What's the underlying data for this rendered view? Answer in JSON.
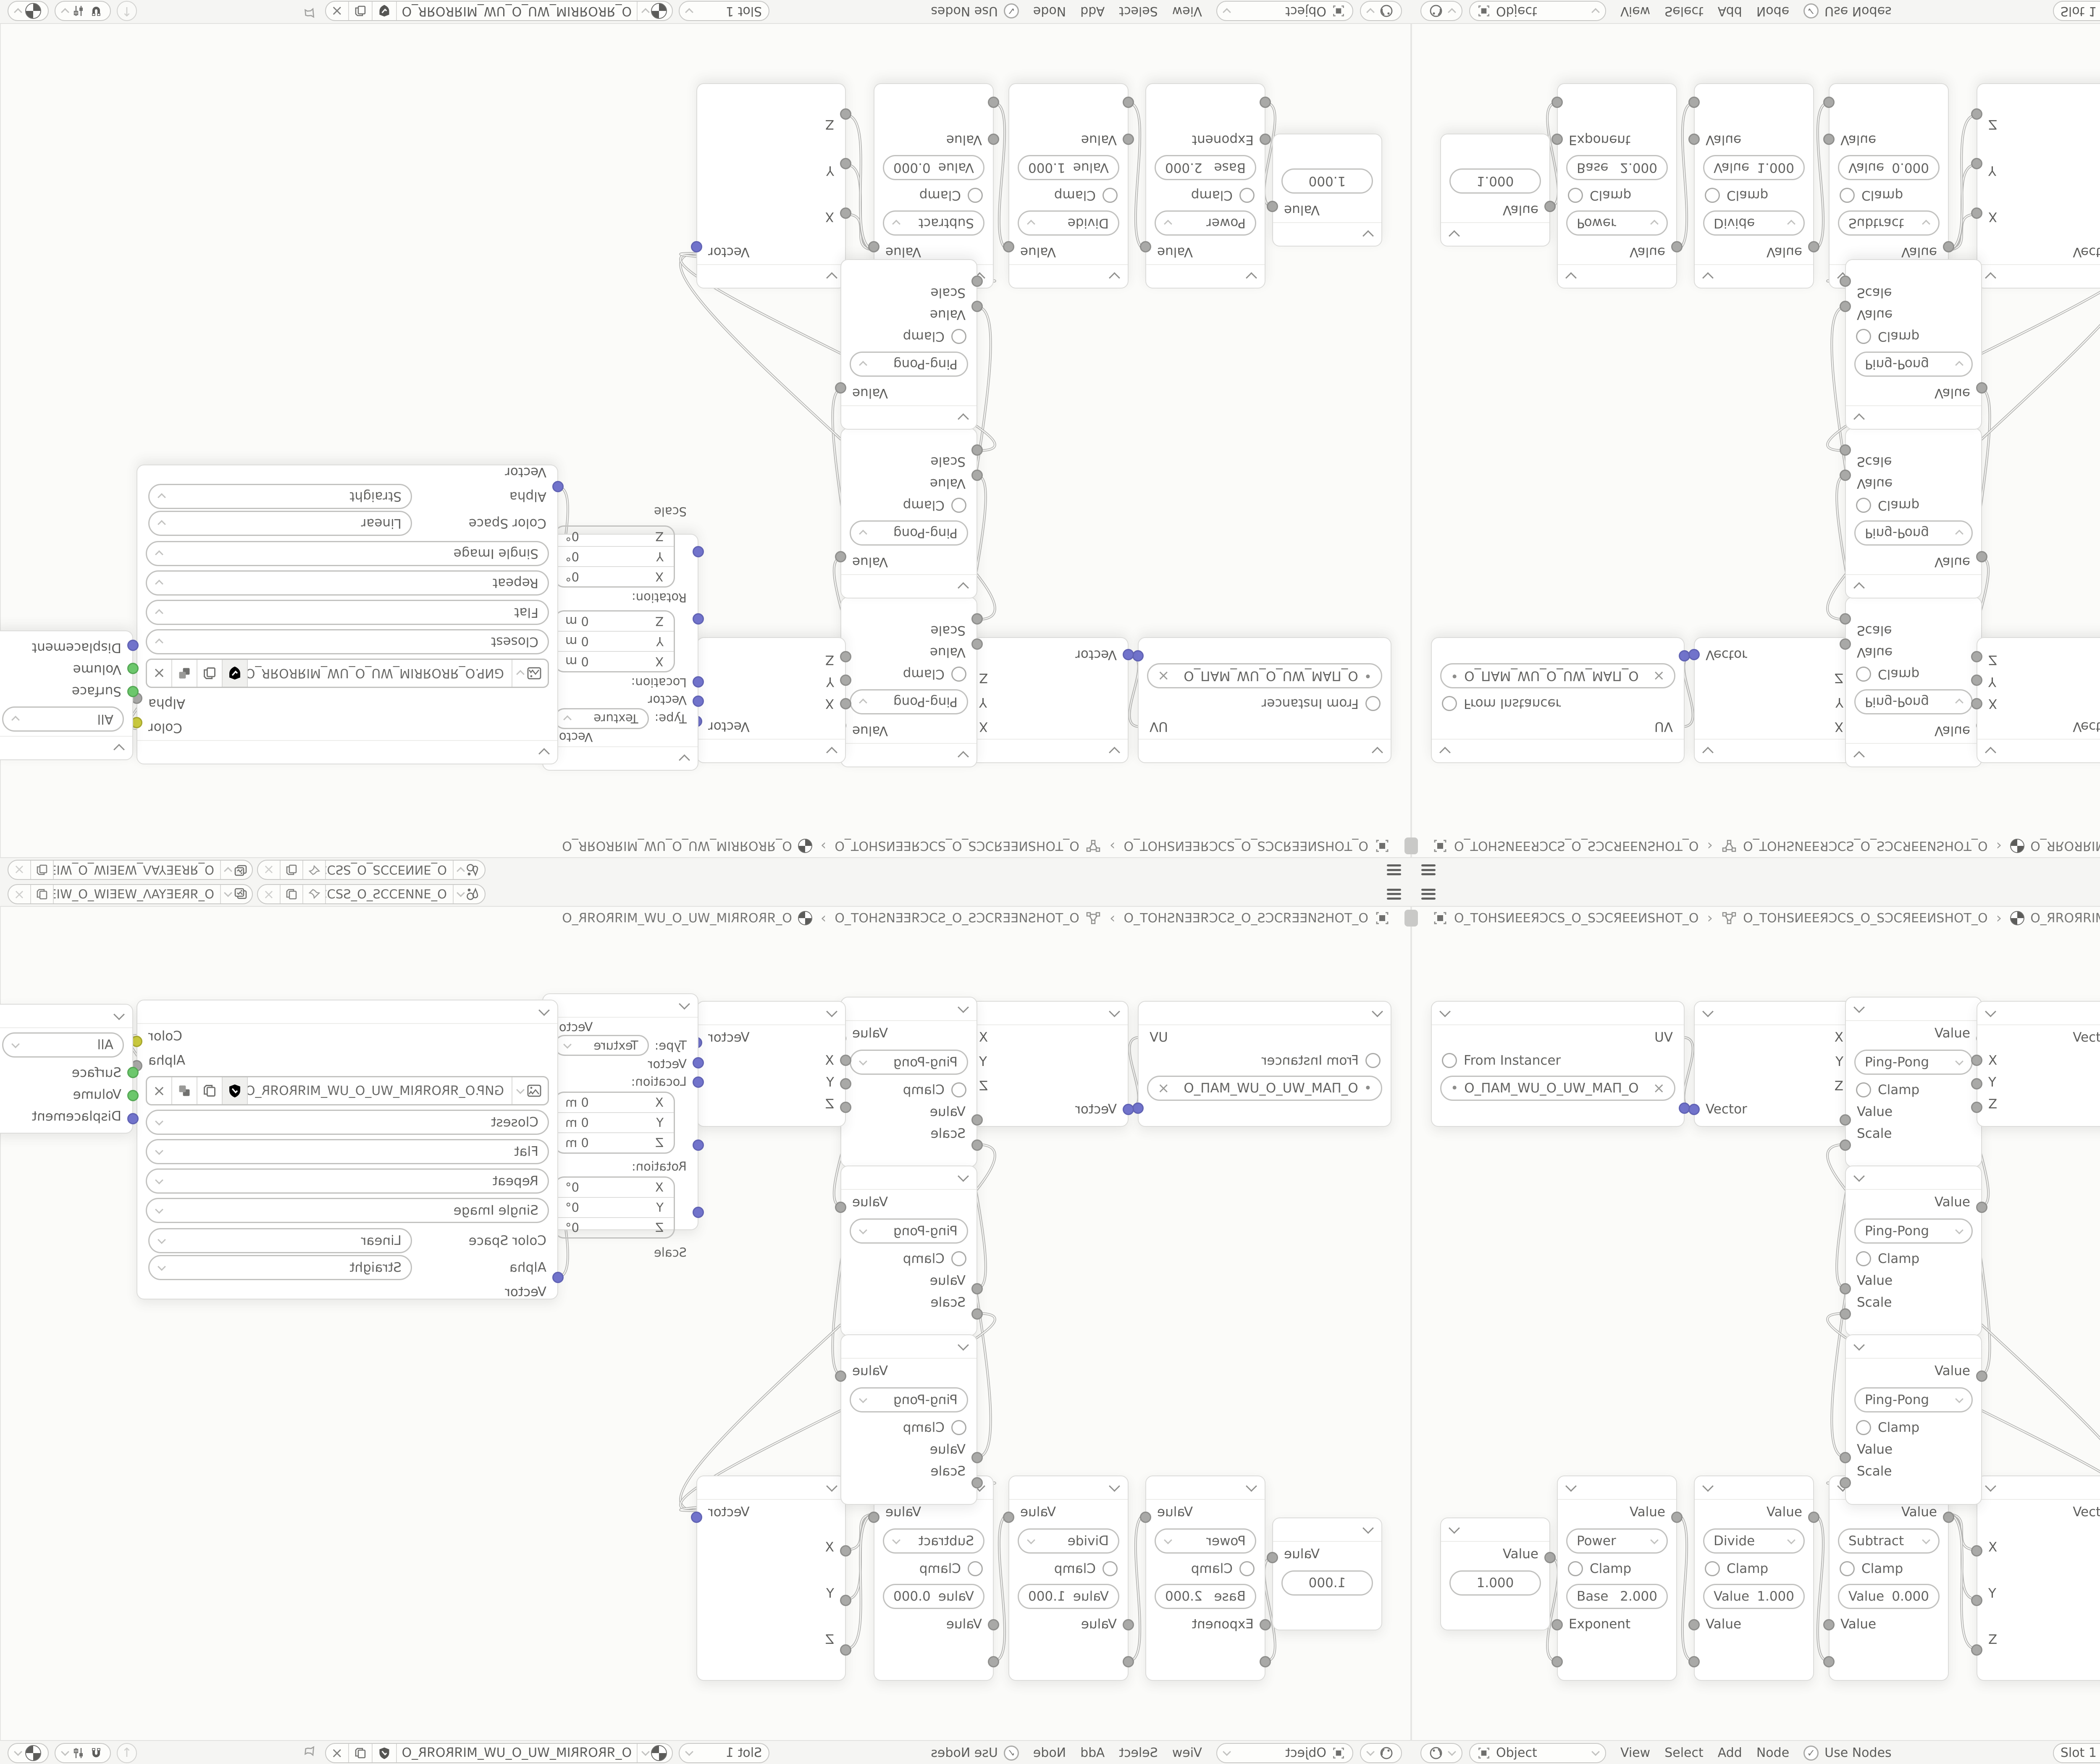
{
  "icons": {
    "close": "×",
    "check": "✓",
    "up_arrow": "↑",
    "dot": "•",
    "pin": "✎"
  },
  "topbar": {
    "scene_name": "O_ƎИИƎƆƆS_O_SƧƆƆƎИ...",
    "view_layer_name": "O_ЯRƎEYAΛ_WƎEIW_O_WIƎEW_ΛAYƎER_O"
  },
  "breadcrumb": {
    "separator": "›",
    "items": [
      {
        "label": "O_TOHSИEEЯƆCS_O_SƆCЯEEИSHOT_O"
      },
      {
        "label": "O_TOHSИEEЯƆCS_O_SƆCЯEEИSHOT_O"
      },
      {
        "label": "O_ЯROЯRIM_WU_O_UW_MIЯROЯR_O"
      }
    ]
  },
  "header": {
    "shader_type": "Object",
    "menus": [
      "View",
      "Select",
      "Add",
      "Node"
    ],
    "use_nodes_label": "Use Nodes",
    "slot_label": "Slot 1",
    "material_name": "O_ЯROЯRIM_WU_O_UW_MIЯROЯR_O"
  },
  "nodes": {
    "uv_map": {
      "output": "UV",
      "from_instancer": "From Instancer",
      "uv_name": "O_ПAM_WU_O_UW_MAП_O"
    },
    "separate_xyz": {
      "out_x": "X",
      "out_y": "Y",
      "out_z": "Z",
      "input": "Vector"
    },
    "pingpong": {
      "output": "Value",
      "operation": "Ping-Pong",
      "clamp": "Clamp",
      "input_value": "Value",
      "input_scale": "Scale"
    },
    "combine_xyz_top": {
      "output": "Vector",
      "in_x": "X",
      "in_y": "Y",
      "in_z": "Z"
    },
    "mapping": {
      "output": "Vector",
      "type_label": "Type:",
      "type_value": "Texture",
      "input": "Vector",
      "location_label": "Location:",
      "location_rows": [
        {
          "axis": "X",
          "value": "0 m"
        },
        {
          "axis": "Y",
          "value": "0 m"
        },
        {
          "axis": "Z",
          "value": "0 m"
        }
      ],
      "rotation_label": "Rotation:",
      "rotation_rows": [
        {
          "axis": "X",
          "value": "0°"
        },
        {
          "axis": "Y",
          "value": "0°"
        },
        {
          "axis": "Z",
          "value": "0°"
        }
      ],
      "scale_label": "Scale"
    },
    "image_texture": {
      "out_color": "Color",
      "out_alpha": "Alpha",
      "filename": "GИP.O_ЯROЯRIM_WU_O_UW_MIЯROЯR_O.PNG",
      "interpolation": "Closest",
      "projection": "Flat",
      "extension": "Repeat",
      "source": "Single Image",
      "color_space_label": "Color Space",
      "color_space_value": "Linear",
      "alpha_label": "Alpha",
      "alpha_value": "Straight",
      "input": "Vector"
    },
    "material_output": {
      "target": "All",
      "in_surface": "Surface",
      "in_volume": "Volume",
      "in_displacement": "Displacement"
    },
    "value": {
      "output": "Value",
      "value": "1.000"
    },
    "power": {
      "output": "Value",
      "operation": "Power",
      "clamp": "Clamp",
      "field_label": "Base",
      "field_value": "2.000",
      "input": "Exponent"
    },
    "divide": {
      "output": "Value",
      "operation": "Divide",
      "clamp": "Clamp",
      "field_label": "Value",
      "field_value": "1.000",
      "input": "Value"
    },
    "subtract": {
      "output": "Value",
      "operation": "Subtract",
      "clamp": "Clamp",
      "field_label": "Value",
      "field_value": "0.000",
      "input": "Value"
    },
    "combine_xyz_bottom": {
      "output": "Vector",
      "in_x": "X",
      "in_y": "Y",
      "in_z": "Z"
    }
  },
  "socket_colors": {
    "vector": "#7173cb",
    "value": "#a9a9a7",
    "color": "#cbcb3e",
    "shader": "#6cc76c"
  },
  "links": [
    [
      647,
      255,
      673,
      425
    ],
    [
      1053,
      252,
      1033,
      450
    ],
    [
      1053,
      310,
      1033,
      852
    ],
    [
      1053,
      368,
      1033,
      1254
    ],
    [
      1355,
      255,
      1346,
      308
    ],
    [
      1355,
      657,
      1346,
      364
    ],
    [
      1355,
      1059,
      1346,
      420
    ],
    [
      1698,
      255,
      1697,
      300
    ],
    [
      2065,
      220,
      2031,
      825
    ],
    [
      3031,
      250,
      3043,
      336
    ],
    [
      327,
      1492,
      347,
      1740
    ],
    [
      629,
      1390,
      673,
      1740
    ],
    [
      955,
      1390,
      994,
      1740
    ],
    [
      1276,
      1390,
      1346,
      1475
    ],
    [
      1276,
      1390,
      1346,
      1593
    ],
    [
      1276,
      1390,
      1346,
      1711
    ],
    [
      1698,
      1382,
      1033,
      510
    ],
    [
      1698,
      1382,
      1033,
      912
    ],
    [
      1698,
      1382,
      1033,
      1314
    ]
  ]
}
